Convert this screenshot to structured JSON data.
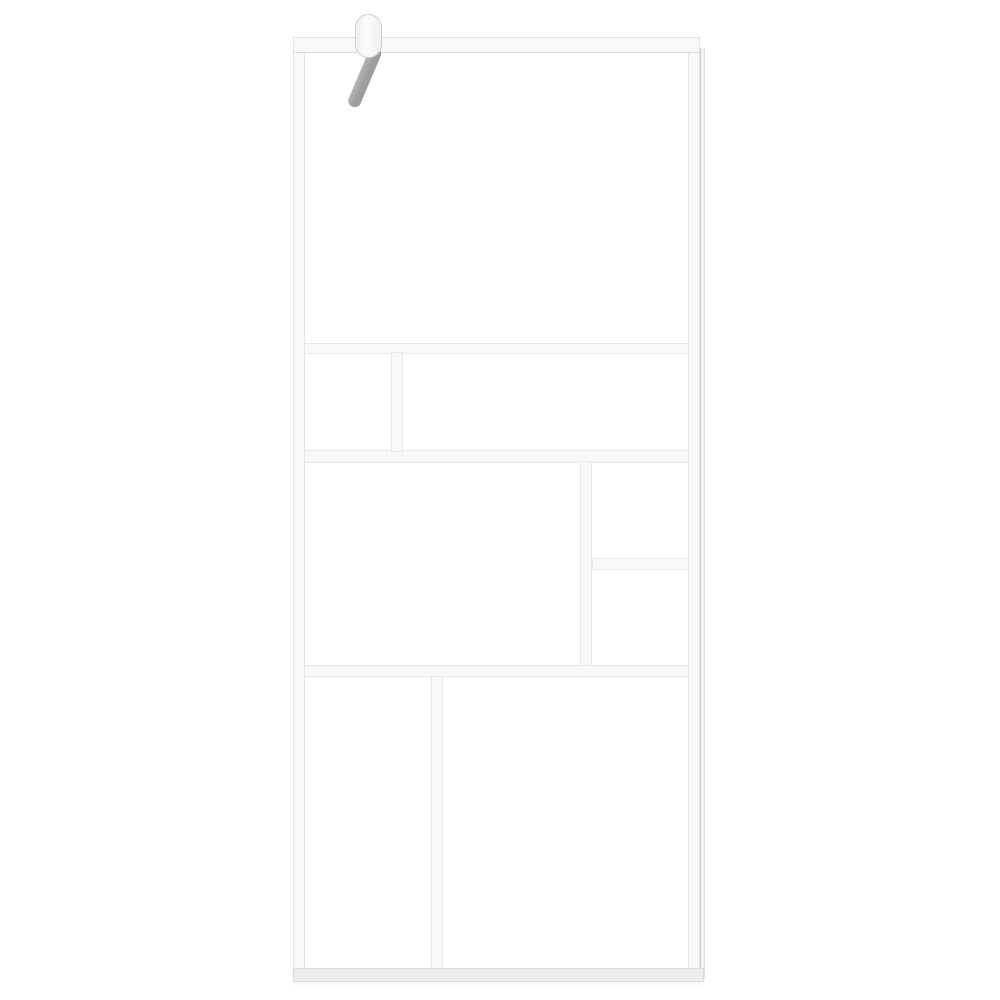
{
  "meta": {
    "kind": "product-photo",
    "subject": "walk-in-shower-screen",
    "description": "White-framed walk-in shower glass screen with eight clear glass panels arranged in an asymmetric grid, a ceiling/wall support arm clamped at the top left, and a wall-mount profile rail on the right edge, photographed on a plain white background. No visible text."
  },
  "colors": {
    "background": "#ffffff",
    "frame_fill": "#f8f8f8",
    "frame_edge": "#e4e4e4",
    "frame_inner_line": "#d9d9d9",
    "bar_edge": "#e8e8e8",
    "frame_bottom_fill": "#ededed",
    "frame_bottom_edge": "#dcdcdc",
    "wall_profile_fill": "#f3f3f3",
    "wall_profile_edge": "#cfcfcf",
    "glass": "#ffffff",
    "support_arm": "#9e9e9e",
    "support_arm_highlight": "#b5b5b5",
    "clamp_fill": "#fcfcfc",
    "clamp_shade": "#efefef",
    "clamp_edge": "#d2d2d2"
  },
  "structure": {
    "frame_parts": [
      "top-rail",
      "left-stile",
      "right-stile",
      "bottom-rail",
      "wall-profile"
    ],
    "inner_bars": [
      "horizontal-upper",
      "horizontal-middle",
      "horizontal-lower",
      "vertical-row2",
      "vertical-row3",
      "vertical-row4",
      "horizontal-sub-right"
    ],
    "glass_panels_count": 8,
    "glass_panels": [
      "top-large-panel",
      "row2-left-small-panel",
      "row2-right-wide-panel",
      "row3-left-large-panel",
      "row3-right-top-small-panel",
      "row3-right-bottom-small-panel",
      "row4-left-tall-panel",
      "row4-right-tall-panel"
    ],
    "hardware": [
      "wall-clamp",
      "diagonal-support-arm"
    ]
  }
}
